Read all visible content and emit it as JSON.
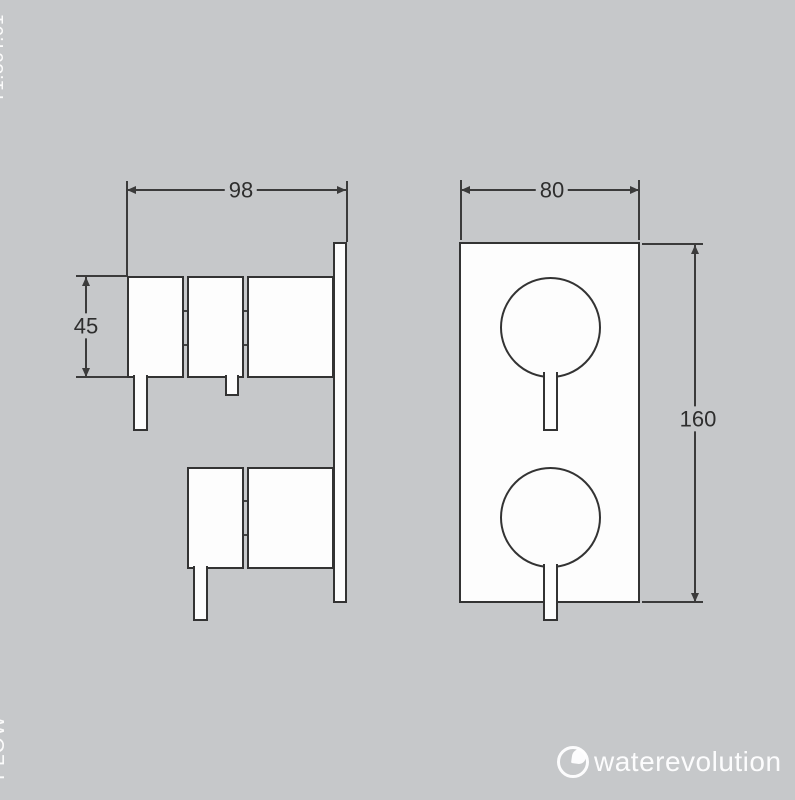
{
  "document": {
    "product_code": "T1.36T.01",
    "category_label": "FLOW"
  },
  "brand": {
    "logo_text": "waterevolution",
    "logo_icon": "water-drop-circle-icon"
  },
  "diagram": {
    "type": "technical-drawing",
    "views": {
      "side": {
        "title": "side-view",
        "dims": {
          "width": "98",
          "height": "45"
        }
      },
      "front": {
        "title": "front-view",
        "dims": {
          "width": "80",
          "height": "160"
        }
      }
    }
  },
  "colors": {
    "background": "#c6c8ca",
    "line": "#3b3b3b",
    "shape_fill": "#fdfdfd",
    "dim_text": "#2e2e2e",
    "label_text": "#f5f5f5"
  }
}
